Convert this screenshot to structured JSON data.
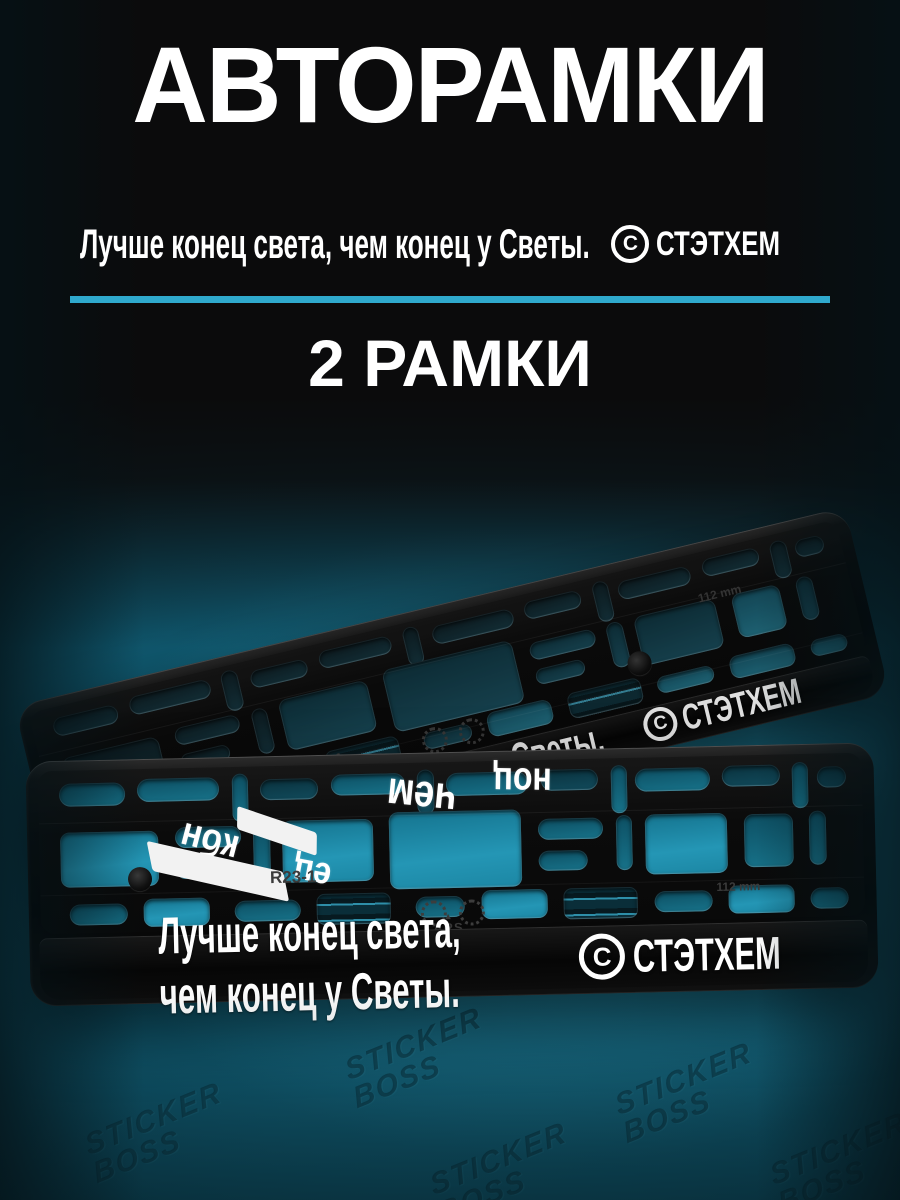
{
  "header": {
    "title": "АВТОРАМКИ",
    "tagline": "Лучше конец света, чем конец у Светы.",
    "brand": "СТЭТХЕМ",
    "brand_symbol": "С",
    "count": "2 РАМКИ"
  },
  "frames": {
    "front": {
      "print_text": "Лучше конец света, чем конец у Светы.",
      "brand": "СТЭТХЕМ",
      "brand_symbol": "С",
      "marking": "R23-1",
      "maker_mark": "ARS",
      "maker_triangle": "▲",
      "size_mark": "112 mm"
    },
    "back": {
      "print_text": "Светы.",
      "brand": "СТЭТХЕМ",
      "brand_symbol": "С",
      "marking": "R23-1",
      "size_mark": "112 mm"
    },
    "reflections": [
      "чем",
      "ноц",
      "кбн",
      "ец"
    ]
  },
  "watermark": {
    "line1": "STICKER",
    "line2": "BOSS"
  },
  "colors": {
    "accent": "#2fa9cd",
    "teal_glow": "#1f8aa8",
    "background": "#0b0b0c"
  }
}
